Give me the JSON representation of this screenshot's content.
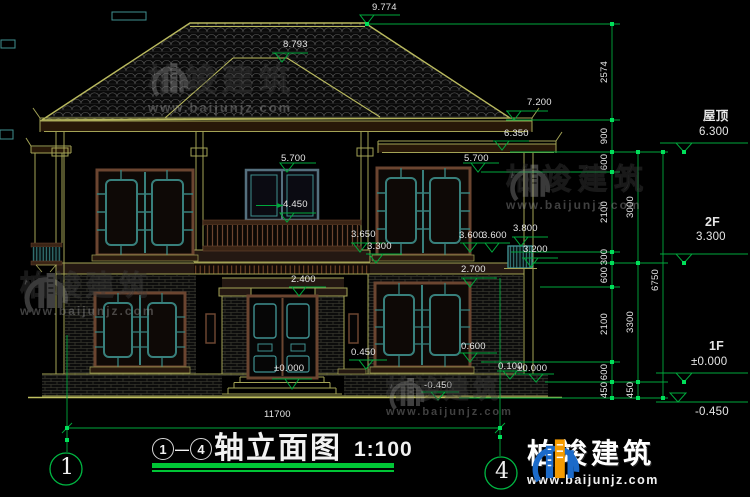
{
  "title_block": {
    "axis_start": "1",
    "separator": "—",
    "axis_end": "4",
    "title": "轴立面图",
    "scale": "1:100"
  },
  "axis_bubbles": {
    "left": "1",
    "right": "4"
  },
  "watermark": {
    "brand": "柏竣建筑",
    "url": "www.baijunjz.com"
  },
  "footer_logo": {
    "brand": "柏竣建筑",
    "url": "www.baijunjz.com"
  },
  "colors": {
    "dimension_green": "#00a83c",
    "grip_green": "#00e05a",
    "line_olive": "#a3a356",
    "roof_line": "#b9b95e",
    "lattice_teal": "#3f8f8f",
    "frame_brown": "#6b4530",
    "text_white": "#e6e6e6",
    "logo_blue": "#1b6ac9",
    "logo_orange": "#f59b00"
  },
  "dim_labels": [
    {
      "t": "9.774",
      "x": 372,
      "y": 3,
      "n": "level-ridge-main"
    },
    {
      "t": "8.793",
      "x": 283,
      "y": 40,
      "n": "level-ridge-front"
    },
    {
      "t": "7.200",
      "x": 527,
      "y": 98,
      "n": "level-eave-main"
    },
    {
      "t": "6.350",
      "x": 504,
      "y": 129,
      "n": "level-eave-wing"
    },
    {
      "t": "5.700",
      "x": 281,
      "y": 154,
      "n": "level-window-head-2f"
    },
    {
      "t": "5.700",
      "x": 464,
      "y": 154,
      "n": "level-window-head-2f"
    },
    {
      "t": "4.450",
      "x": 283,
      "y": 200,
      "n": "level-balcony-rail"
    },
    {
      "t": "3.650",
      "x": 351,
      "y": 230,
      "n": "level-porch-parapet"
    },
    {
      "t": "3.300",
      "x": 367,
      "y": 242,
      "n": "level-2f-floor"
    },
    {
      "t": "3.600",
      "x": 459,
      "y": 231,
      "n": "level-window-sill-2f"
    },
    {
      "t": "3.600",
      "x": 482,
      "y": 231,
      "n": "level-window-sill-2f"
    },
    {
      "t": "3.800",
      "x": 513,
      "y": 224,
      "n": "level-small-window-head"
    },
    {
      "t": "3.200",
      "x": 523,
      "y": 245,
      "n": "level-small-window-sill"
    },
    {
      "t": "2.700",
      "x": 461,
      "y": 265,
      "n": "level-window-head-1f"
    },
    {
      "t": "2.400",
      "x": 291,
      "y": 275,
      "n": "level-door-head"
    },
    {
      "t": "0.450",
      "x": 351,
      "y": 348,
      "n": "level-ledge"
    },
    {
      "t": "0.600",
      "x": 461,
      "y": 342,
      "n": "level-window-sill-1f"
    },
    {
      "t": "0.100",
      "x": 498,
      "y": 362,
      "n": "level-plinth"
    },
    {
      "t": "±0.000",
      "x": 517,
      "y": 364,
      "n": "level-ground-floor"
    },
    {
      "t": "±0.000",
      "x": 274,
      "y": 364,
      "n": "level-entry-floor"
    },
    {
      "t": "-0.450",
      "x": 424,
      "y": 381,
      "n": "level-grade"
    },
    {
      "t": "11700",
      "x": 264,
      "y": 410,
      "n": "overall-width-dim"
    },
    {
      "t": "屋顶",
      "x": 703,
      "y": 110,
      "cls": "lvl",
      "n": "story-label-roof"
    },
    {
      "t": "6.300",
      "x": 699,
      "y": 126,
      "cls": "big",
      "n": "story-level-roof"
    },
    {
      "t": "2F",
      "x": 705,
      "y": 216,
      "cls": "lvl",
      "n": "story-label-2f"
    },
    {
      "t": "3.300",
      "x": 696,
      "y": 231,
      "cls": "big",
      "n": "story-level-2f"
    },
    {
      "t": "1F",
      "x": 709,
      "y": 340,
      "cls": "lvl",
      "n": "story-label-1f"
    },
    {
      "t": "±0.000",
      "x": 691,
      "y": 356,
      "cls": "big",
      "n": "story-level-1f"
    },
    {
      "t": "-0.450",
      "x": 695,
      "y": 406,
      "cls": "big",
      "n": "story-level-grade"
    }
  ],
  "chain_labels": [
    {
      "t": "2574",
      "x": 605,
      "y": 72
    },
    {
      "t": "900",
      "x": 605,
      "y": 136
    },
    {
      "t": "600",
      "x": 605,
      "y": 162
    },
    {
      "t": "2100",
      "x": 605,
      "y": 212
    },
    {
      "t": "300",
      "x": 605,
      "y": 257
    },
    {
      "t": "600",
      "x": 605,
      "y": 275
    },
    {
      "t": "2100",
      "x": 605,
      "y": 324
    },
    {
      "t": "600",
      "x": 605,
      "y": 372
    },
    {
      "t": "450",
      "x": 605,
      "y": 390
    },
    {
      "t": "3000",
      "x": 631,
      "y": 207
    },
    {
      "t": "3300",
      "x": 631,
      "y": 322
    },
    {
      "t": "450",
      "x": 631,
      "y": 390
    },
    {
      "t": "6750",
      "x": 656,
      "y": 280
    }
  ]
}
